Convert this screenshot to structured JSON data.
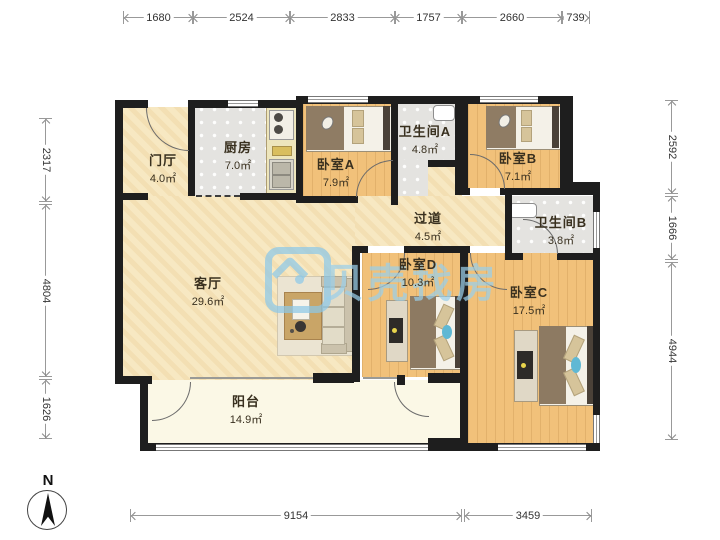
{
  "watermark": {
    "text": "贝壳找房",
    "color": "#9ACEE9"
  },
  "compass": {
    "label": "N"
  },
  "rooms": [
    {
      "name": "门厅",
      "area": "4.0㎡"
    },
    {
      "name": "厨房",
      "area": "7.0㎡"
    },
    {
      "name": "卧室A",
      "area": "7.9㎡"
    },
    {
      "name": "卫生间A",
      "area": "4.8㎡"
    },
    {
      "name": "卧室B",
      "area": "7.1㎡"
    },
    {
      "name": "过道",
      "area": "4.5㎡"
    },
    {
      "name": "卫生间B",
      "area": "3.8㎡"
    },
    {
      "name": "客厅",
      "area": "29.6㎡"
    },
    {
      "name": "卧室D",
      "area": "10.3㎡"
    },
    {
      "name": "卧室C",
      "area": "17.5㎡"
    },
    {
      "name": "阳台",
      "area": "14.9㎡"
    }
  ],
  "dimensions": {
    "top": [
      "1680",
      "2524",
      "2833",
      "1757",
      "2660",
      "739"
    ],
    "left": [
      "2317",
      "4804",
      "1626"
    ],
    "right": [
      "2592",
      "1666",
      "4944"
    ],
    "bottom": [
      "9154",
      "3459"
    ]
  },
  "colors": {
    "wall": "#1E1E1E",
    "wood_floor": "#F1C17A",
    "tile_floor": "#E4E3E0",
    "beige_floor": "#F7E8C2",
    "balcony_floor": "#FBF8E6"
  }
}
